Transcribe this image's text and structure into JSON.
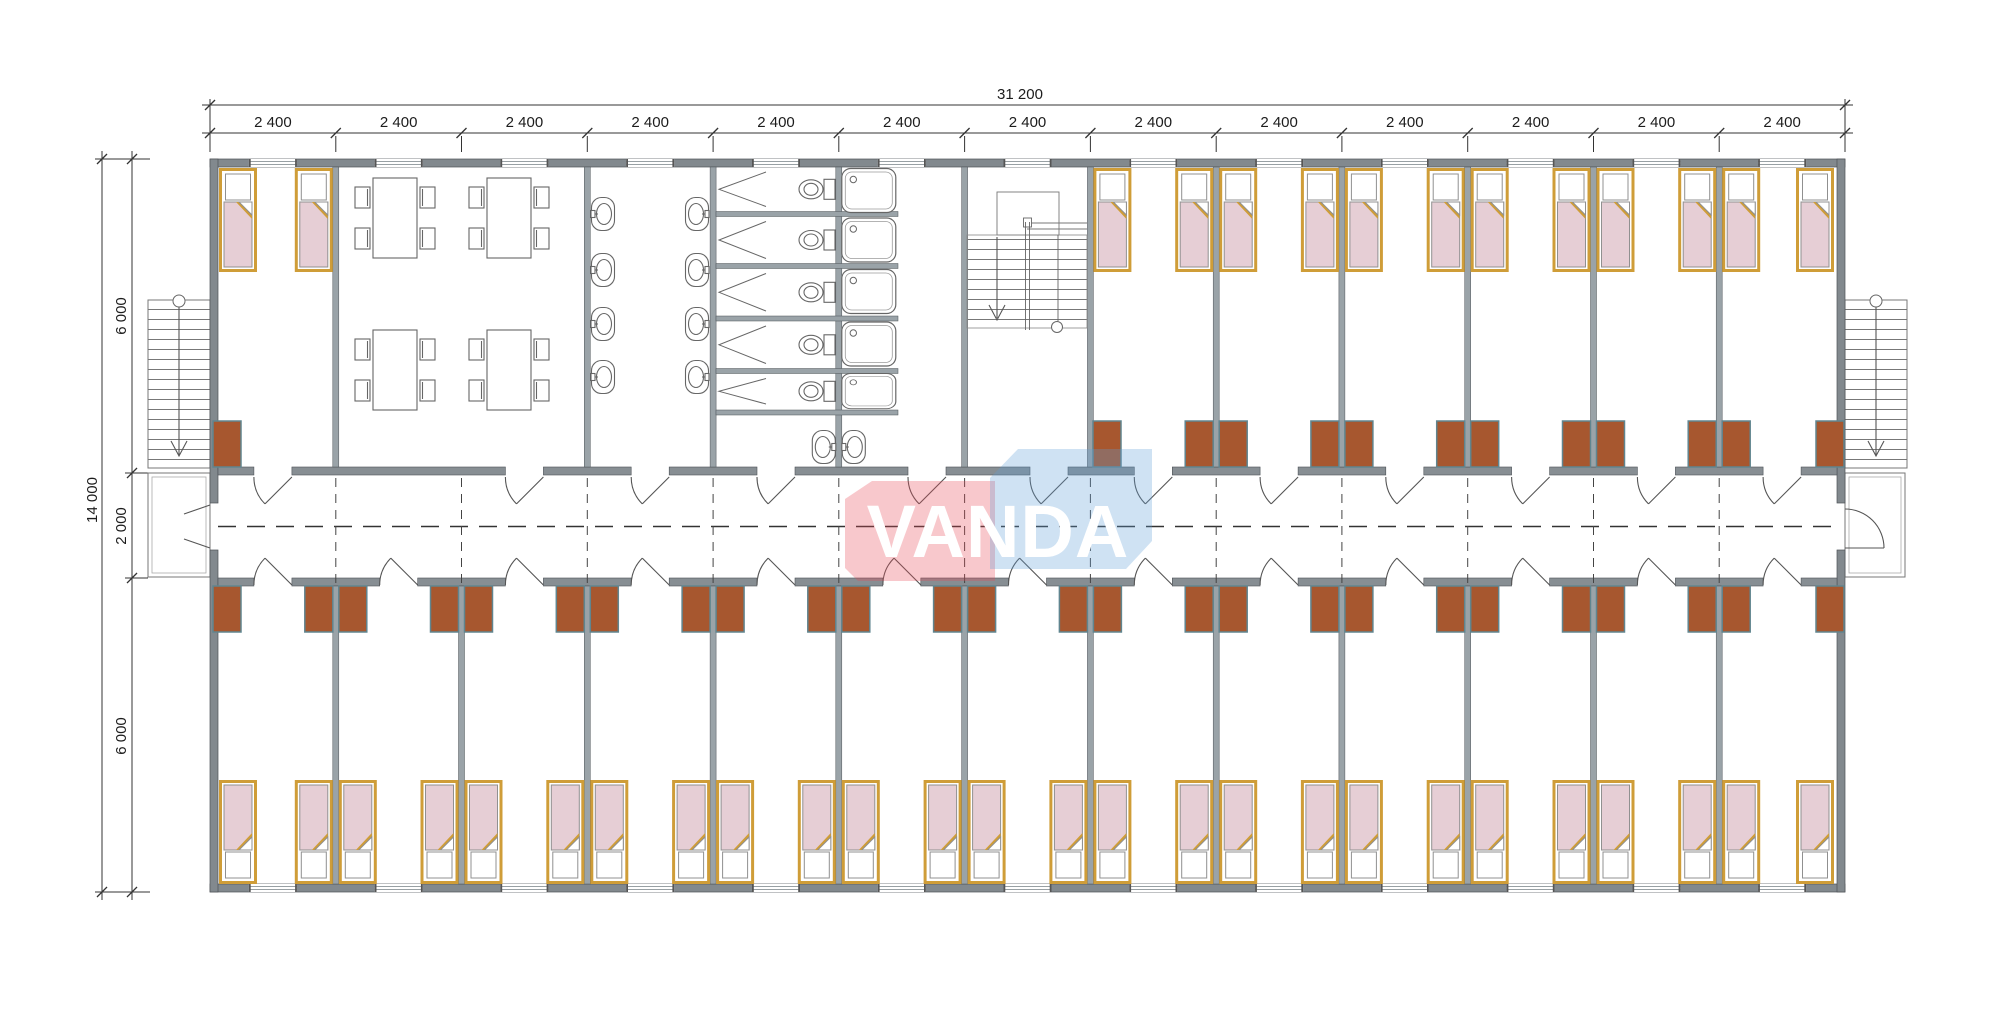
{
  "watermark": {
    "text": "VANDA",
    "pink_color": "#e84957",
    "blue_color": "#609ed6"
  },
  "dimensions": {
    "top": {
      "total": "31 200",
      "segments": [
        "2 400",
        "2 400",
        "2 400",
        "2 400",
        "2 400",
        "2 400",
        "2 400",
        "2 400",
        "2 400",
        "2 400",
        "2 400",
        "2 400",
        "2 400"
      ]
    },
    "left": {
      "total": "14 000",
      "segments": [
        "6 000",
        "2 000",
        "6 000"
      ]
    }
  },
  "palette": {
    "exterior_wall": "#82898e",
    "interior_wall": "#9aa3a8",
    "bed_frame": "#cf9d38",
    "bed_blanket": "#e6ced5",
    "cabinet": "#a7572f",
    "fixture_line": "#666666"
  }
}
